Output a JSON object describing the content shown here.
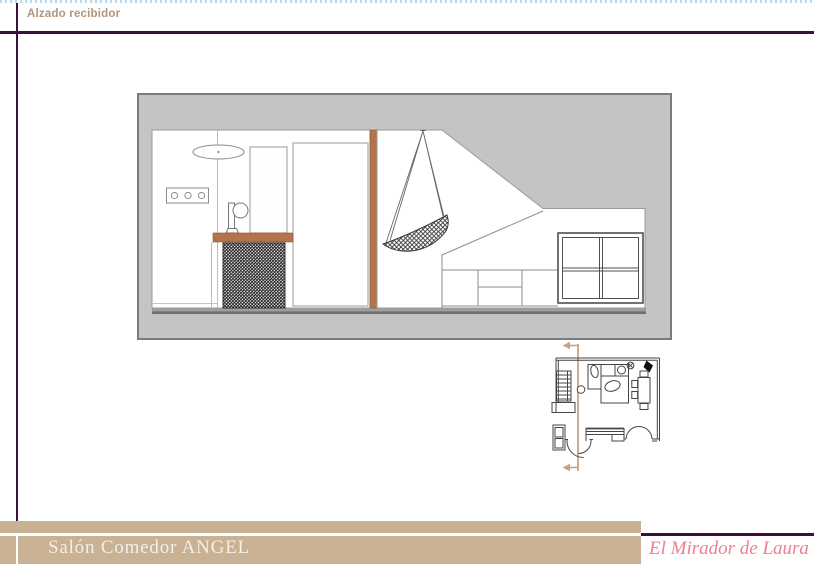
{
  "header": {
    "title": "Alzado recibidor"
  },
  "footer": {
    "project_title": "Salón Comedor ANGEL",
    "brand": "El Mirador de Laura"
  },
  "colors": {
    "top_dotted_border": "#b9d9f3",
    "rule_dark_purple": "#3d0f3d",
    "header_text": "#b2947c",
    "panel_background": "#c4c4c4",
    "panel_border": "#7b7b7b",
    "wood_accent": "#b4734a",
    "footer_bar": "#c9b194",
    "footer_text": "#f3efe8",
    "brand_text": "#ee7e92",
    "section_line": "#c9a285"
  },
  "drawing": {
    "elevation": {
      "name": "Alzado recibidor — hallway elevation",
      "components": [
        "ceiling-lamp",
        "switch-panel",
        "wall-mirror",
        "table-lamp",
        "console-shelf",
        "radiator-grille",
        "interior-door",
        "wood-partition",
        "hanging-chair",
        "sloped-ceiling",
        "sideboard",
        "window"
      ]
    },
    "floor_plan": {
      "name": "Salón comedor floor plan",
      "components": [
        "section-cut-line",
        "stairs",
        "column",
        "sofa",
        "chaise",
        "coffee-table",
        "ceiling-light-symbol",
        "plant",
        "dining-table",
        "dining-chairs",
        "bottom-window",
        "double-door",
        "entrance-door",
        "console-table"
      ]
    }
  }
}
